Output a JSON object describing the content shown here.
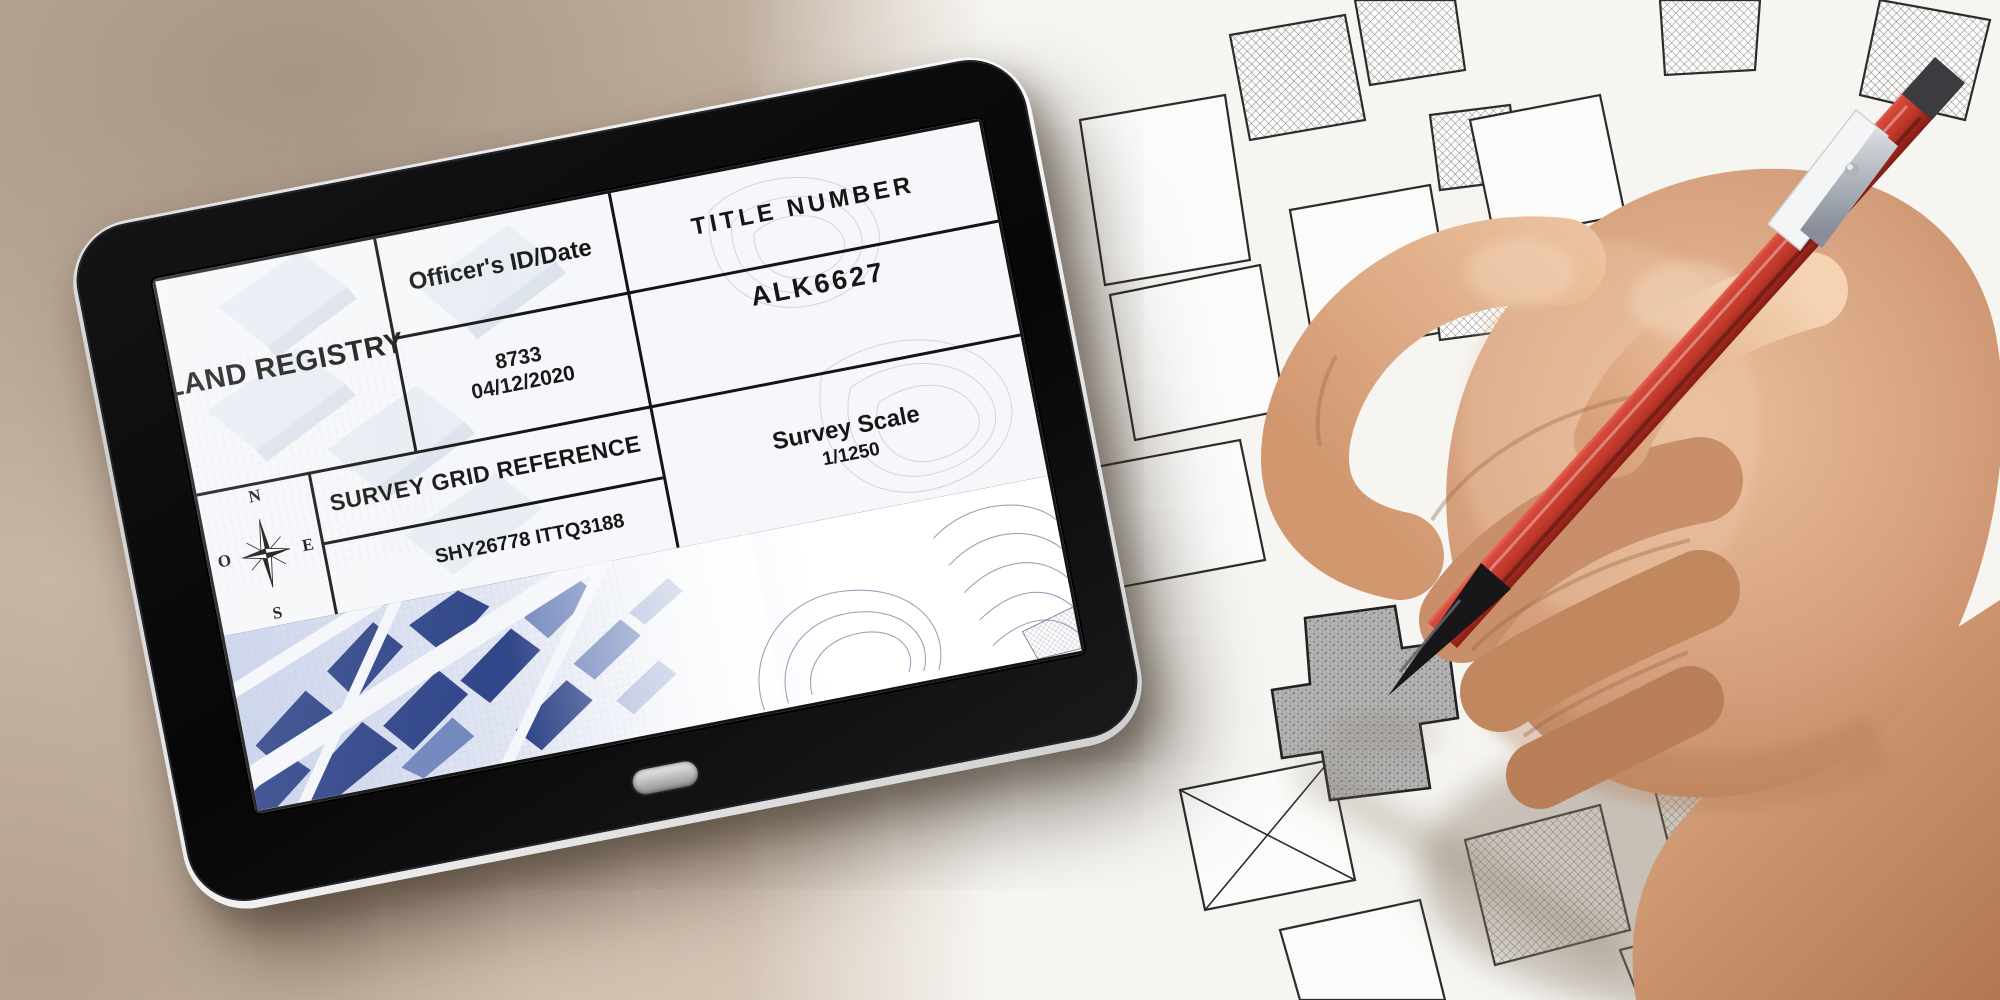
{
  "document": {
    "registry_title": "LAND REGISTRY",
    "officer_header": "Officer's ID/Date",
    "officer_id": "8733",
    "officer_date": "04/12/2020",
    "title_number_header": "TITLE NUMBER",
    "title_number_value": "ALK6627",
    "survey_grid_header": "SURVEY GRID REFERENCE",
    "survey_grid_value": "SHY26778 ITTQ3188",
    "survey_scale_header": "Survey Scale",
    "survey_scale_value": "1/1250",
    "compass": {
      "north": "N",
      "east": "E",
      "south": "S",
      "west": "O"
    }
  },
  "colors": {
    "pencil_red": "#c0392b",
    "tablet_bezel": "#0b0b0d",
    "blueprint_blue": "#32478a",
    "desk_beige": "#c6b4a3",
    "map_paper": "#f6f5f2",
    "skin_tone": "#d59f7c",
    "ink": "#141414"
  }
}
